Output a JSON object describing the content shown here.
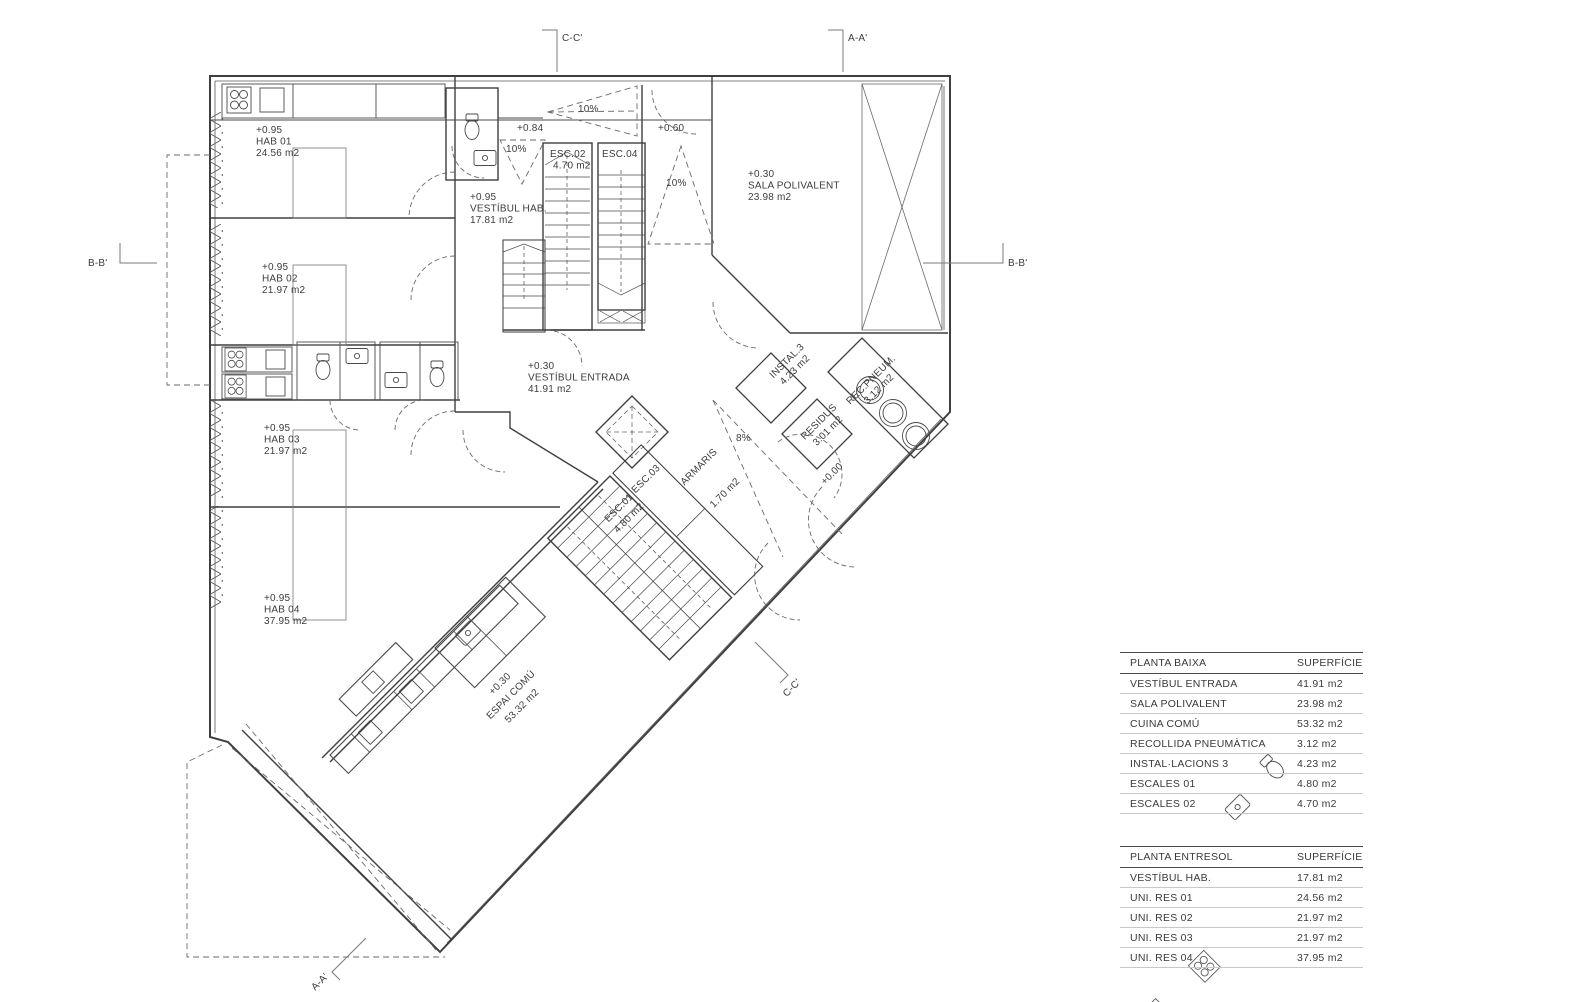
{
  "drawing_title": "Planta baixa - floor plan",
  "plan": {
    "section_markers": {
      "c_top": "C-C'",
      "a_top": "A-A'",
      "b_left": "B-B'",
      "b_right": "B-B'",
      "a_bottom": "A-A'",
      "c_bottom": "C-C'"
    },
    "rooms": {
      "hab01": {
        "level": "+0.95",
        "name": "HAB 01",
        "area": "24.56 m2"
      },
      "hab02": {
        "level": "+0.95",
        "name": "HAB 02",
        "area": "21.97 m2"
      },
      "hab03": {
        "level": "+0.95",
        "name": "HAB 03",
        "area": "21.97 m2"
      },
      "hab04": {
        "level": "+0.95",
        "name": "HAB 04",
        "area": "37.95 m2"
      },
      "vestibul_hab": {
        "level": "+0.95",
        "name": "VESTÍBUL HAB.",
        "area": "17.81 m2"
      },
      "vestibul_entrada": {
        "level": "+0.30",
        "name": "VESTÍBUL ENTRADA",
        "area": "41.91 m2"
      },
      "sala_polivalent": {
        "level": "+0.30",
        "name": "SALA POLIVALENT",
        "area": "23.98 m2"
      },
      "espai_comu": {
        "level": "+0.30",
        "name": "ESPAI COMÚ",
        "area": "53.32 m2"
      },
      "esc01": {
        "name": "ESC.01",
        "area": "4.80 m2"
      },
      "esc02": {
        "name": "ESC.02",
        "area": "4.70 m2"
      },
      "esc03": {
        "name": "ESC.03"
      },
      "esc04": {
        "name": "ESC.04"
      },
      "armaris": {
        "name": "ARMARIS",
        "area": "1.70 m2"
      },
      "instal3": {
        "name": "INSTAL.3",
        "area": "4.23 m2"
      },
      "residus": {
        "name": "RESIDUS",
        "area": "3.01 m2"
      },
      "recpneum": {
        "name": "REC.PNEUM.",
        "area": "3.12 m2"
      }
    },
    "levels": {
      "l084": "+0.84",
      "l060": "+0.60",
      "l000": "+0.00"
    },
    "slopes": {
      "s10a": "10%",
      "s10b": "10%",
      "s10c": "10%",
      "s8": "8%"
    }
  },
  "tables": {
    "baixa": {
      "title": "PLANTA BAIXA",
      "col": "SUPERFÍCIE",
      "rows": [
        {
          "label": "VESTÍBUL ENTRADA",
          "value": "41.91 m2"
        },
        {
          "label": "SALA POLIVALENT",
          "value": "23.98 m2"
        },
        {
          "label": "CUINA COMÚ",
          "value": "53.32 m2"
        },
        {
          "label": "RECOLLIDA PNEUMÀTICA",
          "value": "3.12 m2"
        },
        {
          "label": "INSTAL·LACIONS 3",
          "value": "4.23 m2"
        },
        {
          "label": "ESCALES 01",
          "value": "4.80 m2"
        },
        {
          "label": "ESCALES 02",
          "value": "4.70 m2"
        }
      ]
    },
    "entresol": {
      "title": "PLANTA ENTRESOL",
      "col": "SUPERFÍCIE",
      "rows": [
        {
          "label": "VESTÍBUL HAB.",
          "value": "17.81 m2"
        },
        {
          "label": "UNI. RES 01",
          "value": "24.56 m2"
        },
        {
          "label": "UNI. RES 02",
          "value": "21.97 m2"
        },
        {
          "label": "UNI. RES 03",
          "value": "21.97 m2"
        },
        {
          "label": "UNI. RES 04",
          "value": "37.95 m2"
        }
      ]
    }
  }
}
